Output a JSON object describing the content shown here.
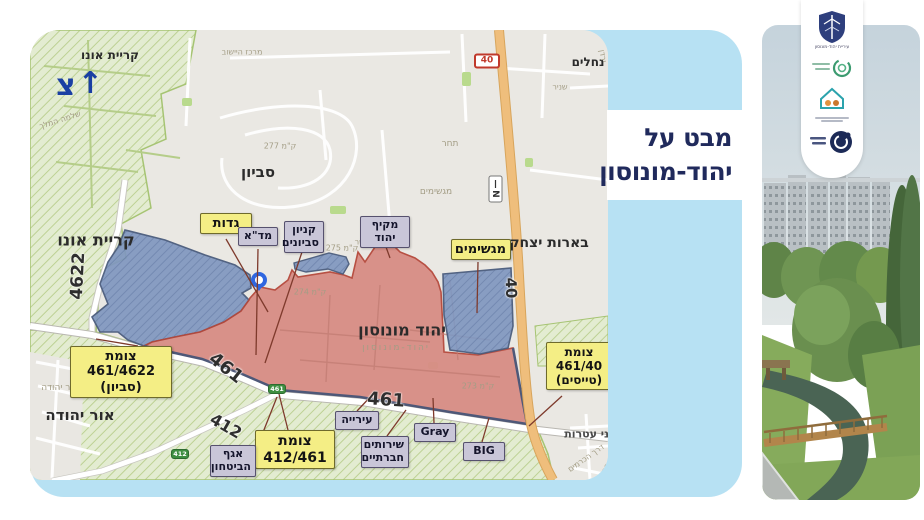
{
  "title": {
    "line1": "מבט על",
    "line2": "יהוד-מונוסון",
    "color": "#202a5c"
  },
  "north": {
    "letter": "צ",
    "arrow": "↑"
  },
  "colors": {
    "panel": "#b7e1f3",
    "map_base": "#eae8e3",
    "green_zone": "#e3ecd1",
    "blue_zone": "#8097c0",
    "red_zone": "#d88d85",
    "road40": "#efbe7c",
    "yellow_box": "#f4ee85",
    "gray_box": "#c9c6d8",
    "title_navy": "#202a5c"
  },
  "map": {
    "labels": [
      {
        "t": "קריית אונו",
        "x": 80,
        "y": 25,
        "s": 12,
        "cls": "bold"
      },
      {
        "t": "סביון",
        "x": 228,
        "y": 142,
        "s": 15,
        "cls": "bold"
      },
      {
        "t": "קריית אונו",
        "x": 66,
        "y": 210,
        "s": 16,
        "cls": "bold"
      },
      {
        "t": "אור יהודה",
        "x": 50,
        "y": 385,
        "s": 15,
        "cls": "bold"
      },
      {
        "t": "בארות יצחק",
        "x": 519,
        "y": 213,
        "s": 14,
        "cls": "bold"
      },
      {
        "t": "נחלים",
        "x": 558,
        "y": 32,
        "s": 12,
        "cls": "bold"
      },
      {
        "t": "בני עטרות",
        "x": 560,
        "y": 404,
        "s": 11,
        "cls": "semi"
      },
      {
        "t": "יהוד מונוסון",
        "x": 372,
        "y": 300,
        "s": 16,
        "cls": "bold"
      },
      {
        "t": "4622",
        "x": 48,
        "y": 246,
        "s": 17,
        "cls": "road",
        "r": -87
      },
      {
        "t": "461",
        "x": 196,
        "y": 338,
        "s": 18,
        "cls": "road",
        "r": 38
      },
      {
        "t": "461",
        "x": 356,
        "y": 370,
        "s": 18,
        "cls": "road",
        "r": 4
      },
      {
        "t": "412",
        "x": 196,
        "y": 396,
        "s": 16,
        "cls": "road",
        "r": 30
      },
      {
        "t": "40",
        "x": 481,
        "y": 258,
        "s": 15,
        "cls": "road",
        "r": 88
      },
      {
        "t": "מרכז היישוב",
        "x": 212,
        "y": 22,
        "s": 8,
        "cls": "faint"
      },
      {
        "t": "שלמה המלך",
        "x": 30,
        "y": 90,
        "s": 8,
        "cls": "faint",
        "r": -18
      },
      {
        "t": "שניר",
        "x": 530,
        "y": 57,
        "s": 8,
        "cls": "faint"
      },
      {
        "t": "ירדן",
        "x": 573,
        "y": 26,
        "s": 8,
        "cls": "faint",
        "r": 80
      },
      {
        "t": "מגשימים",
        "x": 406,
        "y": 162,
        "s": 9,
        "cls": "faint"
      },
      {
        "t": "תחר",
        "x": 420,
        "y": 114,
        "s": 9,
        "cls": "faint"
      },
      {
        "t": "ק\"מ 277",
        "x": 250,
        "y": 116,
        "s": 8,
        "cls": "faint"
      },
      {
        "t": "ק\"מ 275",
        "x": 312,
        "y": 218,
        "s": 8,
        "cls": "faint"
      },
      {
        "t": "ק\"מ 274",
        "x": 280,
        "y": 262,
        "s": 8,
        "cls": "faint"
      },
      {
        "t": "ק\"מ 273",
        "x": 448,
        "y": 356,
        "s": 8,
        "cls": "faint"
      },
      {
        "t": "אור יהודה",
        "x": 30,
        "y": 358,
        "s": 9,
        "cls": "faint"
      },
      {
        "t": "יהוד-מונוסון",
        "x": 366,
        "y": 318,
        "s": 9,
        "cls": "faint",
        "ls": 2
      },
      {
        "t": "גני ישר",
        "x": 336,
        "y": 212,
        "s": 8,
        "cls": "faint"
      },
      {
        "t": "דרך הכרמים",
        "x": 556,
        "y": 428,
        "s": 8,
        "cls": "faint",
        "r": -35
      },
      {
        "t": "דרך הראשונים",
        "x": 574,
        "y": 441,
        "s": 8,
        "cls": "faint",
        "r": -62
      }
    ],
    "shields": [
      {
        "t": "40",
        "x": 457,
        "y": 31,
        "type": "red"
      },
      {
        "t": "461",
        "x": 247,
        "y": 359,
        "type": "green"
      },
      {
        "t": "412",
        "x": 150,
        "y": 424,
        "type": "green"
      }
    ],
    "n_marker": "N",
    "yellow_callouts": [
      {
        "lines": [
          "גדות"
        ],
        "x": 170,
        "y": 183,
        "w": 52,
        "fs": 13,
        "leader": [
          196,
          209,
          238,
          282
        ]
      },
      {
        "lines": [
          "מגשימים"
        ],
        "x": 421,
        "y": 209,
        "w": 60,
        "fs": 13,
        "leader": [
          448,
          232,
          447,
          283
        ]
      },
      {
        "lines": [
          "צומת 461/4622",
          "(סביון)"
        ],
        "x": 40,
        "y": 316,
        "w": 102,
        "fs": 13,
        "leader": [
          108,
          316,
          66,
          309
        ]
      },
      {
        "lines": [
          "צומת",
          "412/461"
        ],
        "x": 225,
        "y": 400,
        "w": 80,
        "fs": 14,
        "leader": [
          258,
          400,
          249,
          364
        ]
      },
      {
        "lines": [
          "צומת",
          "461/40",
          "(טייסים)"
        ],
        "x": 516,
        "y": 312,
        "w": 66,
        "fs": 12,
        "leader": [
          532,
          366,
          499,
          396
        ]
      }
    ],
    "gray_callouts": [
      {
        "lines": [
          "מד\"א"
        ],
        "x": 208,
        "y": 197,
        "w": 40,
        "fs": 11,
        "leader": [
          228,
          219,
          226,
          325
        ]
      },
      {
        "lines": [
          "קניון",
          "סביונים"
        ],
        "x": 254,
        "y": 191,
        "w": 40,
        "fs": 11,
        "leader": [
          272,
          222,
          235,
          333
        ]
      },
      {
        "lines": [
          "מקיף יהוד"
        ],
        "x": 330,
        "y": 186,
        "w": 50,
        "fs": 11,
        "leader": [
          352,
          206,
          360,
          228
        ]
      },
      {
        "lines": [
          "עירייה"
        ],
        "x": 305,
        "y": 381,
        "w": 44,
        "fs": 11,
        "leader": [
          327,
          381,
          344,
          363
        ]
      },
      {
        "lines": [
          "שירותים",
          "חברתיים"
        ],
        "x": 331,
        "y": 406,
        "w": 48,
        "fs": 11,
        "leader": [
          357,
          406,
          376,
          380
        ]
      },
      {
        "lines": [
          "Gray"
        ],
        "x": 384,
        "y": 393,
        "w": 42,
        "fs": 11,
        "leader": [
          404,
          393,
          403,
          368
        ]
      },
      {
        "lines": [
          "BIG"
        ],
        "x": 433,
        "y": 412,
        "w": 42,
        "fs": 11,
        "leader": [
          452,
          412,
          459,
          388
        ]
      },
      {
        "lines": [
          "אגף",
          "הביטחון"
        ],
        "x": 180,
        "y": 415,
        "w": 46,
        "fs": 11,
        "leader": [
          226,
          420,
          247,
          367
        ]
      }
    ]
  },
  "logos": [
    {
      "name": "city-emblem-logo",
      "caption": "עיריית יהוד-מונוסון"
    },
    {
      "name": "green-circular-logo",
      "caption": ""
    },
    {
      "name": "house-community-logo",
      "caption": ""
    },
    {
      "name": "navy-circle-logo",
      "caption": ""
    }
  ]
}
